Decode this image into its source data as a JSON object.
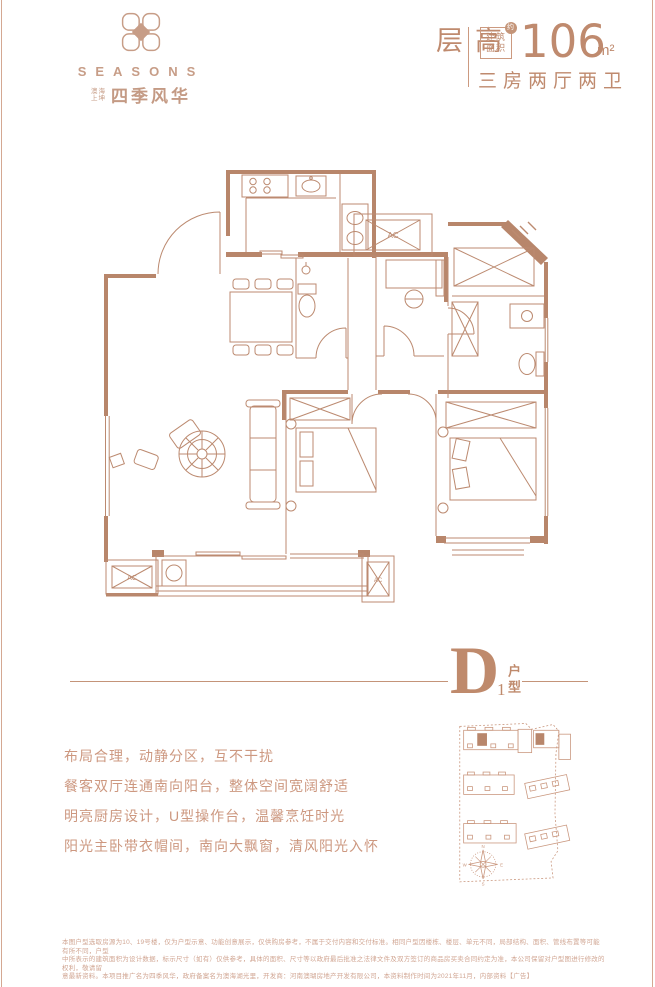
{
  "page": {
    "background": "#ffffff",
    "accent": "#bf8a6e",
    "logo_color": "#c79d87",
    "plan_wall_color": "#b8866b",
    "plan_line_color": "#bc8a70",
    "feature_text_color": "#cd9880",
    "disclaimer_color": "#d1a693"
  },
  "header": {
    "logo": {
      "brand": "SEASONS",
      "sub_line1": "澳海",
      "sub_line2": "上坤",
      "project": "四季风华"
    },
    "spec": {
      "building_type": "高层",
      "area_label_l1": "建筑",
      "area_label_l2": "面积",
      "approx": "约",
      "area_value": "106",
      "area_unit": "m²",
      "layout": "三房两厅两卫"
    }
  },
  "unit": {
    "letter": "D",
    "number": "1",
    "type_label": "户型"
  },
  "features": [
    "布局合理，动静分区，互不干扰",
    "餐客双厅连通南向阳台，整体空间宽阔舒适",
    "明亮厨房设计，U型操作台，温馨烹饪时光",
    "阳光主卧带衣帽间，南向大飘窗，清风阳光入怀"
  ],
  "floorplan": {
    "ac_label": "AC"
  },
  "siteplan": {
    "compass": {
      "n": "N",
      "e": "E",
      "s": "S",
      "w": "W"
    }
  },
  "disclaimer": [
    "本图户型选取房源为10、19号楼，仅为户型示意、功能创意展示，仅供购房参考，不属于交付内容和交付标准。相同户型因楼栋、楼层、单元不同，局部结构、面积、管线布置等可能有所不同，户型",
    "中所表示的建筑面积为设计数据，标示尺寸（如有）仅供参考，具体的面积、尺寸等以政府最后批准之法律文件及双方签订的商品房买卖合同约定为准，本公司保留对户型图进行修改的权利，敬请留",
    "意最新资料。本项目推广名为四季风华，政府备案名为澳海湖光里，开发商：河南澳瑚房地产开发有限公司，本资料制作时间为2021年11月，内部资料【广告】"
  ]
}
